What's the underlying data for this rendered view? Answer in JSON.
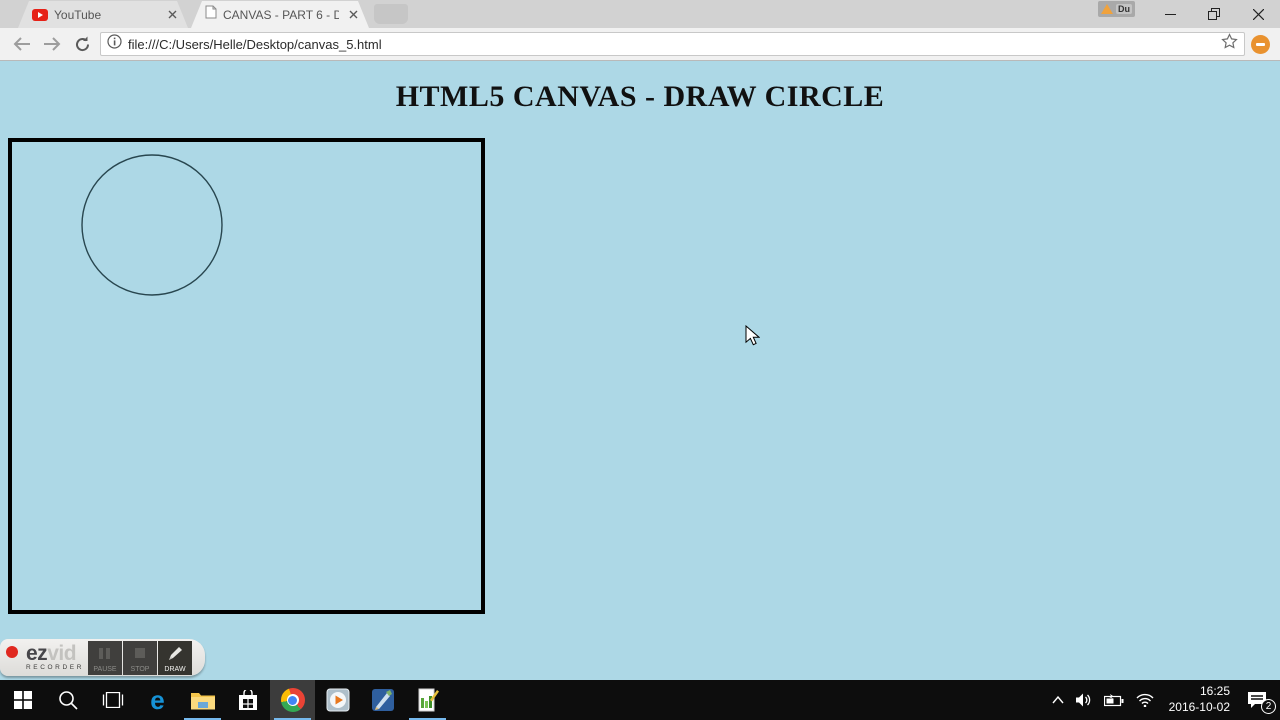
{
  "browser": {
    "tab_youtube": "YouTube",
    "tab_active": "CANVAS - PART 6 - DRA",
    "url": "file:///C:/Users/Helle/Desktop/canvas_5.html",
    "warning_badge": "Du"
  },
  "page": {
    "title": "HTML5 CANVAS - DRAW CIRCLE",
    "bg_color": "#add8e6",
    "canvas": {
      "border_color": "#000000",
      "circle": {
        "cx": "140",
        "cy": "83",
        "r": "70",
        "stroke": "#28464f"
      }
    }
  },
  "ezvid": {
    "brand_bold": "ez",
    "brand_light": "vid",
    "brand_sub": "RECORDER",
    "btn_pause": "PAUSE",
    "btn_stop": "STOP",
    "btn_draw": "DRAW"
  },
  "taskbar": {
    "tray": {
      "time": "16:25",
      "date": "2016-10-02",
      "notification_count": "2"
    }
  },
  "icons": {
    "edge_glyph": "e"
  },
  "colors": {
    "accent_underline": "#76b9ed",
    "extension_orange": "#e9922f",
    "taskbar_bg": "#0d0d0d"
  }
}
